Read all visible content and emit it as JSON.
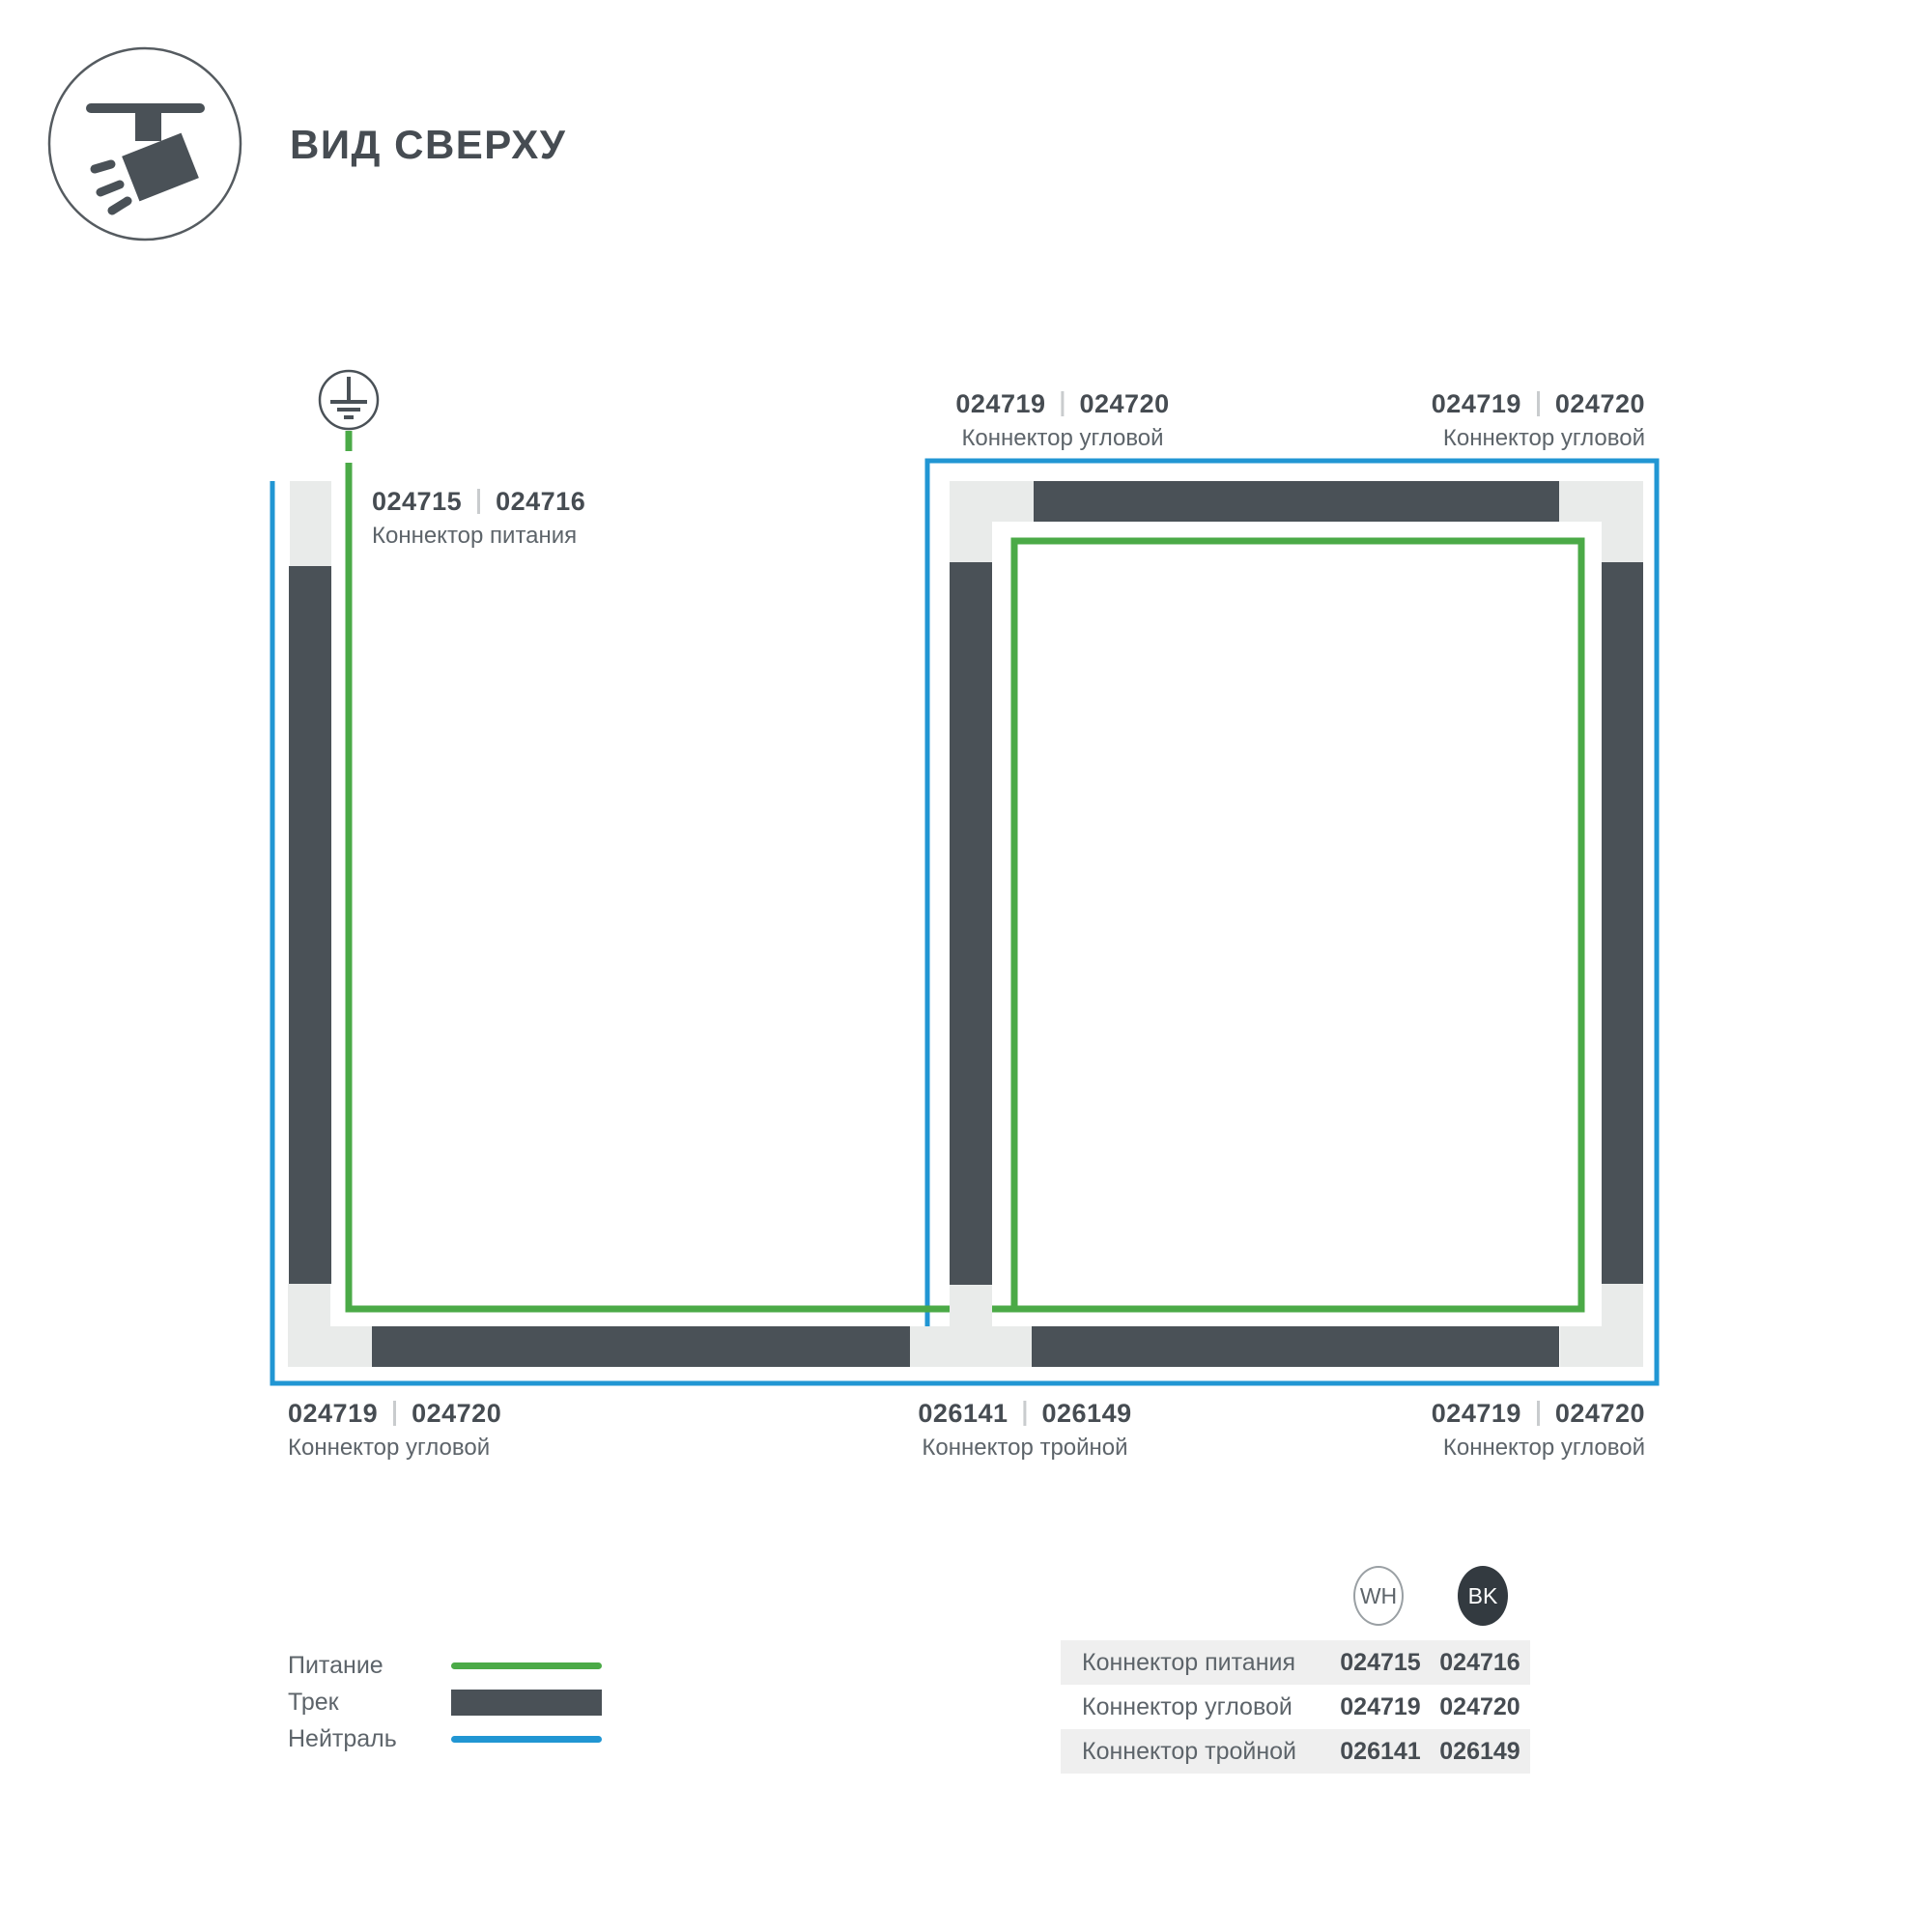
{
  "header": {
    "title": "ВИД СВЕРХУ",
    "icon": "track-light-icon"
  },
  "colors": {
    "power": "#4BAA47",
    "neutral": "#2196D3",
    "track": "#4A5157",
    "connector": "#E9EBEA",
    "text_primary": "#464C52",
    "text_secondary": "#5D646A",
    "row_alt": "#EFEFEF",
    "bk_badge": "#333A40",
    "divider": "#C9CCCE"
  },
  "diagram": {
    "ground_icon": "ground-symbol",
    "labels": {
      "power": {
        "code_wh": "024715",
        "code_bk": "024716",
        "name": "Коннектор питания"
      },
      "corner_top_mid": {
        "code_wh": "024719",
        "code_bk": "024720",
        "name": "Коннектор угловой"
      },
      "corner_top_right": {
        "code_wh": "024719",
        "code_bk": "024720",
        "name": "Коннектор угловой"
      },
      "corner_bottom_left": {
        "code_wh": "024719",
        "code_bk": "024720",
        "name": "Коннектор угловой"
      },
      "triple_bottom": {
        "code_wh": "026141",
        "code_bk": "026149",
        "name": "Коннектор тройной"
      },
      "corner_bottom_right": {
        "code_wh": "024719",
        "code_bk": "024720",
        "name": "Коннектор угловой"
      }
    }
  },
  "legend": {
    "power": "Питание",
    "track": "Трек",
    "neutral": "Нейтраль"
  },
  "table": {
    "headers": {
      "wh": "WH",
      "bk": "BK"
    },
    "rows": [
      {
        "name": "Коннектор питания",
        "wh": "024715",
        "bk": "024716"
      },
      {
        "name": "Коннектор угловой",
        "wh": "024719",
        "bk": "024720"
      },
      {
        "name": "Коннектор тройной",
        "wh": "026141",
        "bk": "026149"
      }
    ]
  }
}
